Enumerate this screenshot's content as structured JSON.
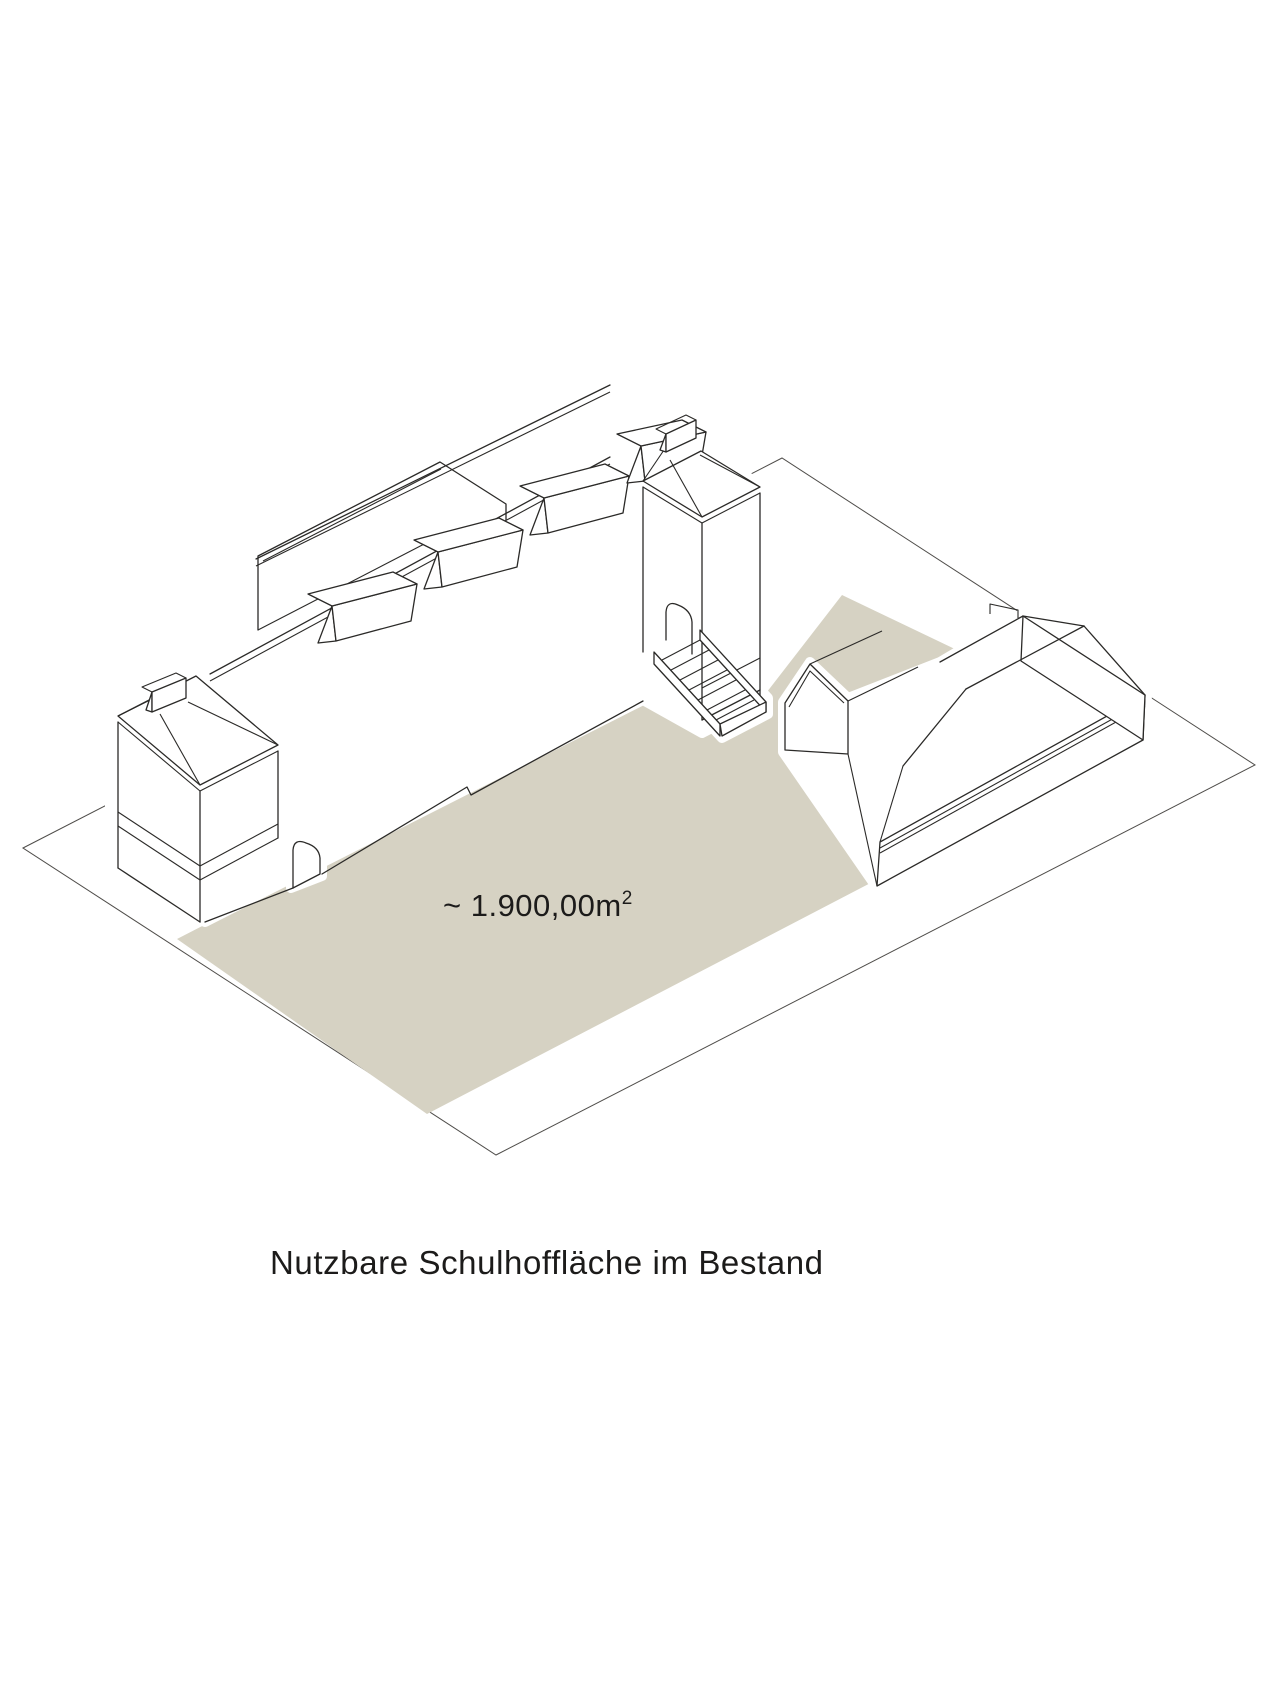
{
  "diagram": {
    "area_label": {
      "value": "~ 1.900,00m",
      "superscript": "2"
    },
    "caption": "Nutzbare Schulhoffläche im Bestand",
    "colors": {
      "courtyard_fill": "#d6d2c3",
      "line": "#2b2a28",
      "boundary_line": "#4f4d4a",
      "background": "#ffffff",
      "text": "#1c1b1a"
    },
    "elements": {
      "site_boundary": "thin-line parallelogram plot outline",
      "courtyard": "beige usable schoolyard surface",
      "school_building": "long historic school building with two towers, dormers, rear annex and entry stair",
      "gym_building": "hipped-roof gym hall with gabled porch annex"
    }
  }
}
